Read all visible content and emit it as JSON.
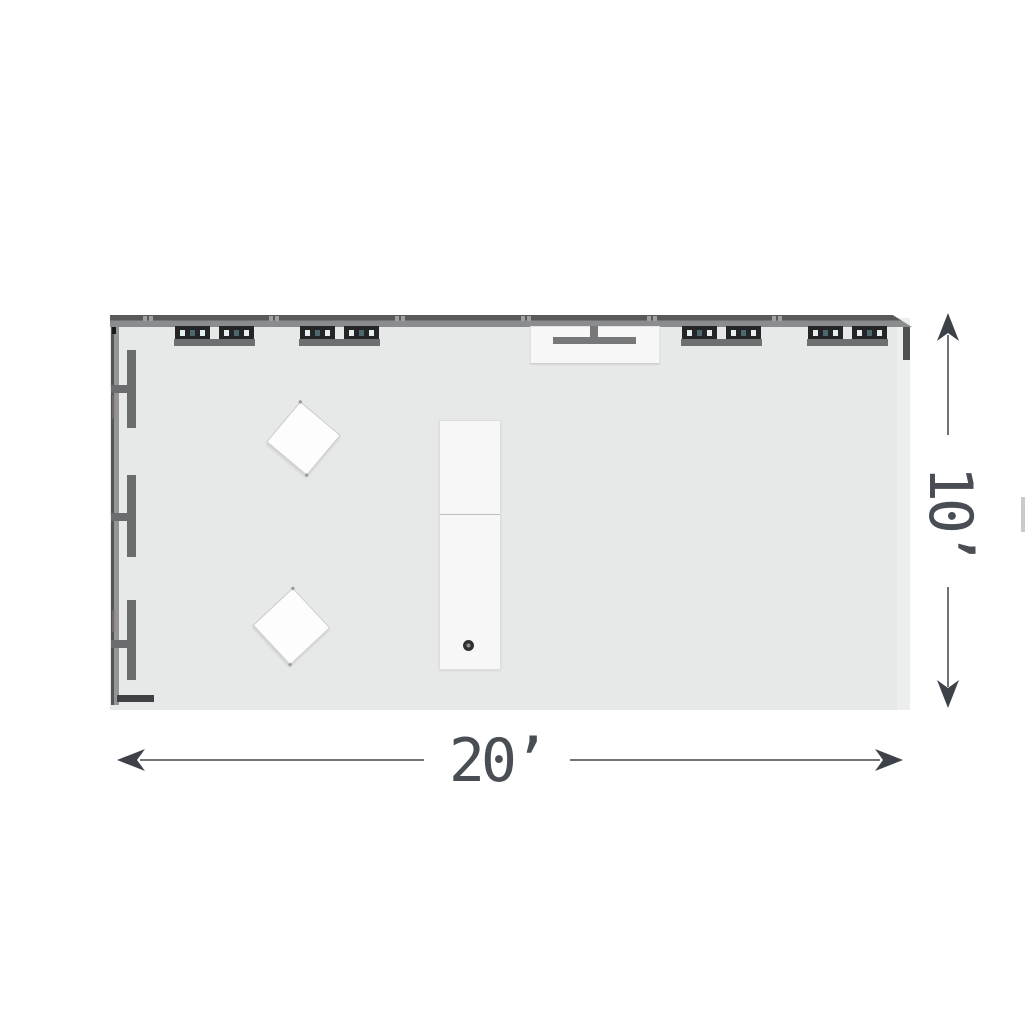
{
  "plan": {
    "type": "exhibit-booth-floor-plan",
    "view": "top-down",
    "dimension_width": {
      "label": "20’"
    },
    "dimension_height": {
      "label": "10’"
    },
    "colors": {
      "floor": "#e7e8e8",
      "wall_dark": "#58595b",
      "wall_mid": "#8b8c8e",
      "fixture_block": "#232527",
      "fixture_base": "#6e6f71",
      "lens_outer": "#e6eef0",
      "lens_center": "#4c676e",
      "panel": "#f7f7f8",
      "bracket": "#77787a",
      "knob": "#2e3032",
      "dim_text": "#494e54",
      "dim_line": "#70757a",
      "arrowhead": "#3d4248"
    },
    "objects": {
      "back_wall": "back wall",
      "shelf_unit": "lighted shelf unit",
      "side_fixture": "side wall panel fixture",
      "monitor_mount": "monitor wall mount",
      "counter": "storage counter with knob",
      "table": "angled display table"
    }
  }
}
